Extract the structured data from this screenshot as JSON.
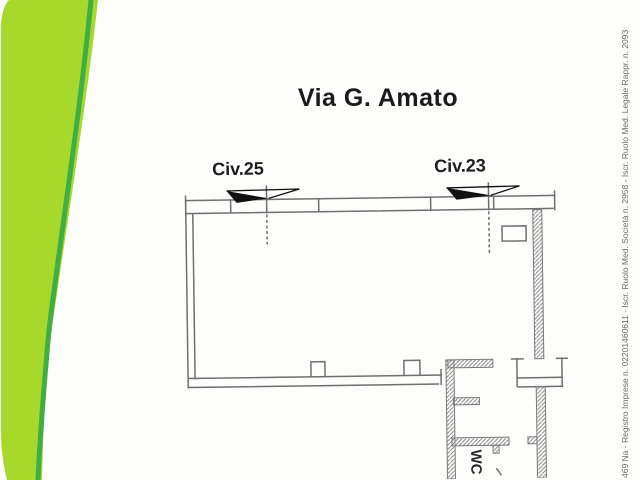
{
  "title": "Via G. Amato",
  "plan": {
    "civ25_label": "Civ.25",
    "civ23_label": "Civ.23",
    "wc_label": "WC"
  },
  "side_text": "469 Na - Registro Imprese n. 02201460611 - Iscr. Ruolo Med. Società n. 2958 - Iscr. Ruolo Med. Legale Rappr. n. 2093",
  "colors": {
    "band_light": "#a7d92c",
    "band_dark": "#3fae43",
    "plan_line": "#6f6f6f",
    "hatch_line": "#8a8a8a",
    "marker_black": "#111111",
    "title_text": "#1b1b1b",
    "side_text_color": "#6a6a6a",
    "paper": "#fdfdfb"
  }
}
